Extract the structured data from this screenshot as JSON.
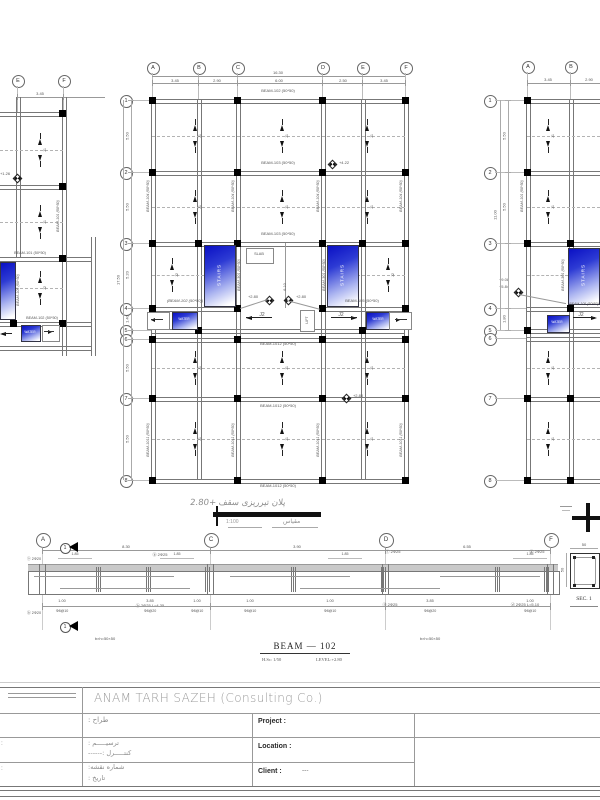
{
  "sheet": {
    "company": "ANAM TARH SAZEH (Consulting Co.)",
    "caption": {
      "title_fa": "پلان تيرريزى سقف  +2.80",
      "scale_value": "1:100",
      "scale_label": "مقياس"
    },
    "title_block": {
      "designer_label": "طراح :",
      "draft_label": "ترسيـــــم :",
      "control_label": "كنتـــــرل :------",
      "sheet_no_label": "شماره نقشه:",
      "date_label": "تاريخ :",
      "project_label": "Project :",
      "location_label": "Location :",
      "client_label": "Client :",
      "client_value": "---",
      "left_mark1": ":",
      "left_mark2": ":"
    }
  },
  "main_plan": {
    "cols": [
      "A",
      "B",
      "C",
      "D",
      "E",
      "F"
    ],
    "rows": [
      "1",
      "2",
      "3",
      "4",
      "5",
      "6",
      "7",
      "8"
    ],
    "top_total": "16.30",
    "top_dims": [
      "3.45",
      "2.90",
      "6.00",
      "2.50",
      "3.45"
    ],
    "left_total": "17.50",
    "left_dims": [
      "5.50",
      "5.50",
      "5.20",
      "1.40",
      "5.50",
      "5.50"
    ],
    "beams_h": [
      "BEAM-102 (50*50)",
      "BEAM-103 (50*50)",
      "BEAM-103 (50*50)",
      "(BEAM-102 (50*50))",
      "BEAM-105 (50*50)",
      "BEAM-1012 (50*50)",
      "BEAM-1012 (50*50)",
      "BEAM-1012 (50*50)"
    ],
    "beams_v": [
      "BEAM-104 (50*50)",
      "BEAM-104 (50*50)",
      "BEAM-104 (50*50)",
      "BEAM-104 (50*50)",
      "BEAM-301 (50*50)",
      "BEAM-301 (50*50)",
      "BEAM-1011 (50*50)",
      "BEAM-1011 (50*50)",
      "BEAM-1011 (50*50)",
      "BEAM-1011 (50*50)"
    ],
    "j1": "J1",
    "j2": "J2",
    "stairs": "STAIRS",
    "water": "WATER",
    "slab": "SLAB",
    "lift": "LIFT",
    "shaft_width": "6.10",
    "levels": [
      "+4.22",
      "+2.80",
      "+2.80",
      "+2.80"
    ]
  },
  "left_plan": {
    "cols": [
      "E",
      "F"
    ],
    "top_dim": "3.45",
    "level": "+1.26",
    "beam_h1": "BEAM-101 (50*50)",
    "beam_h2": "BEAM-102 (50*50)",
    "beam_v1": "BEAM-101 (50*50)",
    "beam_v2": "BEAM-105 (50*50)",
    "water": "WATER",
    "j1": "J1",
    "j2": "J2"
  },
  "right_plan": {
    "cols": [
      "A",
      "B"
    ],
    "rows": [
      "1",
      "2",
      "3",
      "4",
      "5",
      "6",
      "7",
      "8"
    ],
    "top_dims": [
      "3.45",
      "2.90"
    ],
    "left_dims": [
      "5.50",
      "5.50"
    ],
    "dim_45": "1.80",
    "left_total": "11.00",
    "levels": [
      "+9.08",
      "+5.84"
    ],
    "stairs": "STAIRS",
    "water": "WATER",
    "j1": "J1",
    "j2": "J2",
    "beam_v1": "BEAM-101 (50*50)",
    "beam_v2": "BEAM-301 (50*50)",
    "beam_h1": "BEAM-105 (50*50)"
  },
  "beam_elev": {
    "bubbles": [
      "A",
      "C",
      "D",
      "F"
    ],
    "span_dims": [
      "8.30",
      "3.90",
      "6.55"
    ],
    "zone_dims": [
      "1.85",
      "1.85",
      "1.85",
      "1.85"
    ],
    "bot_dims": [
      "1.00",
      "3.85",
      "1.00",
      "1.00",
      "1.00",
      "3.85",
      "1.00"
    ],
    "bot_notes": [
      "Φ8@10",
      "Φ8@20",
      "Φ8@10",
      "Φ8@10",
      "Φ8@10",
      "Φ8@20",
      "Φ8@10"
    ],
    "callouts_top": [
      "ⓑ 2Φ25",
      "ⓒ 2Φ25",
      "ⓓ 2Φ25"
    ],
    "callouts_bot": [
      "ⓑ 2Φ25 L=4.35",
      "ⓒ 2Φ25",
      "ⓓ 2Φ25 L=5.10"
    ],
    "end_top": "ⓐ 2Φ20",
    "end_bot": "ⓑ 2Φ20",
    "size_notes": [
      "b×h=50×50",
      "b×h=50×50"
    ],
    "cut_mark": "1",
    "title": "BEAM  —  102",
    "sub_scale": "H.Sc: 1/50",
    "sub_level": "LEVEL:+2.80",
    "sec_title": "SEC. 1",
    "sec_dim_w": "50",
    "sec_dim_h": "50"
  }
}
